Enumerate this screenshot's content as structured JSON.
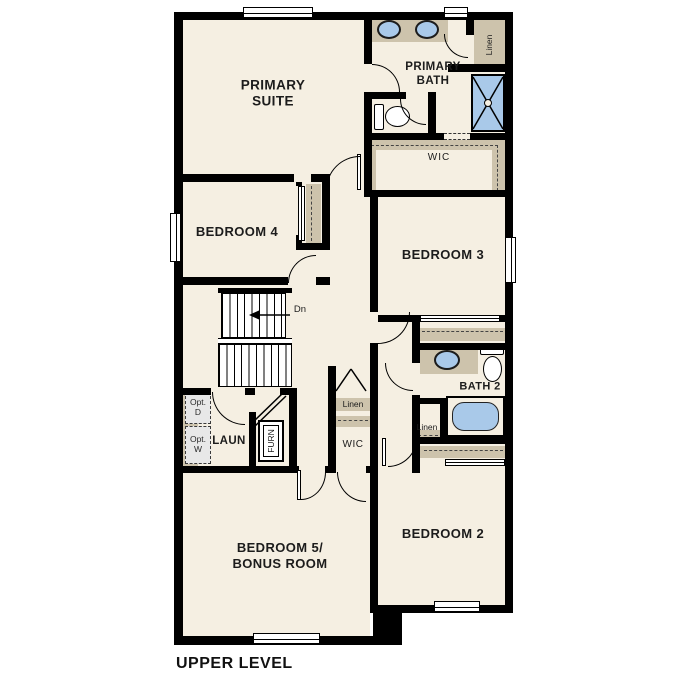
{
  "plan": {
    "title": "UPPER LEVEL",
    "rooms": {
      "primary_suite": "PRIMARY\nSUITE",
      "primary_bath": "PRIMARY\nBATH",
      "bedroom_4": "BEDROOM 4",
      "bedroom_3": "BEDROOM 3",
      "bedroom_2": "BEDROOM 2",
      "bedroom_5": "BEDROOM 5/\nBONUS ROOM",
      "bath_2": "BATH 2",
      "laundry": "LAUN"
    },
    "closets": {
      "wic_primary": "WIC",
      "wic_hall": "WIC",
      "linen_primary": "Linen",
      "linen_hall": "Linen",
      "linen_bath2": "Linen"
    },
    "annotations": {
      "stairs_down": "Dn",
      "furnace": "FURN",
      "optional_dryer": "Opt.\nD",
      "optional_washer": "Opt.\nW"
    },
    "colors": {
      "background": "#ffffff",
      "floor": "#f5efe2",
      "shelf_tan": "#cdc3ac",
      "fixture_blue": "#a9c9e9",
      "wall": "#000000",
      "optional_gray": "#e8e8e8"
    }
  }
}
